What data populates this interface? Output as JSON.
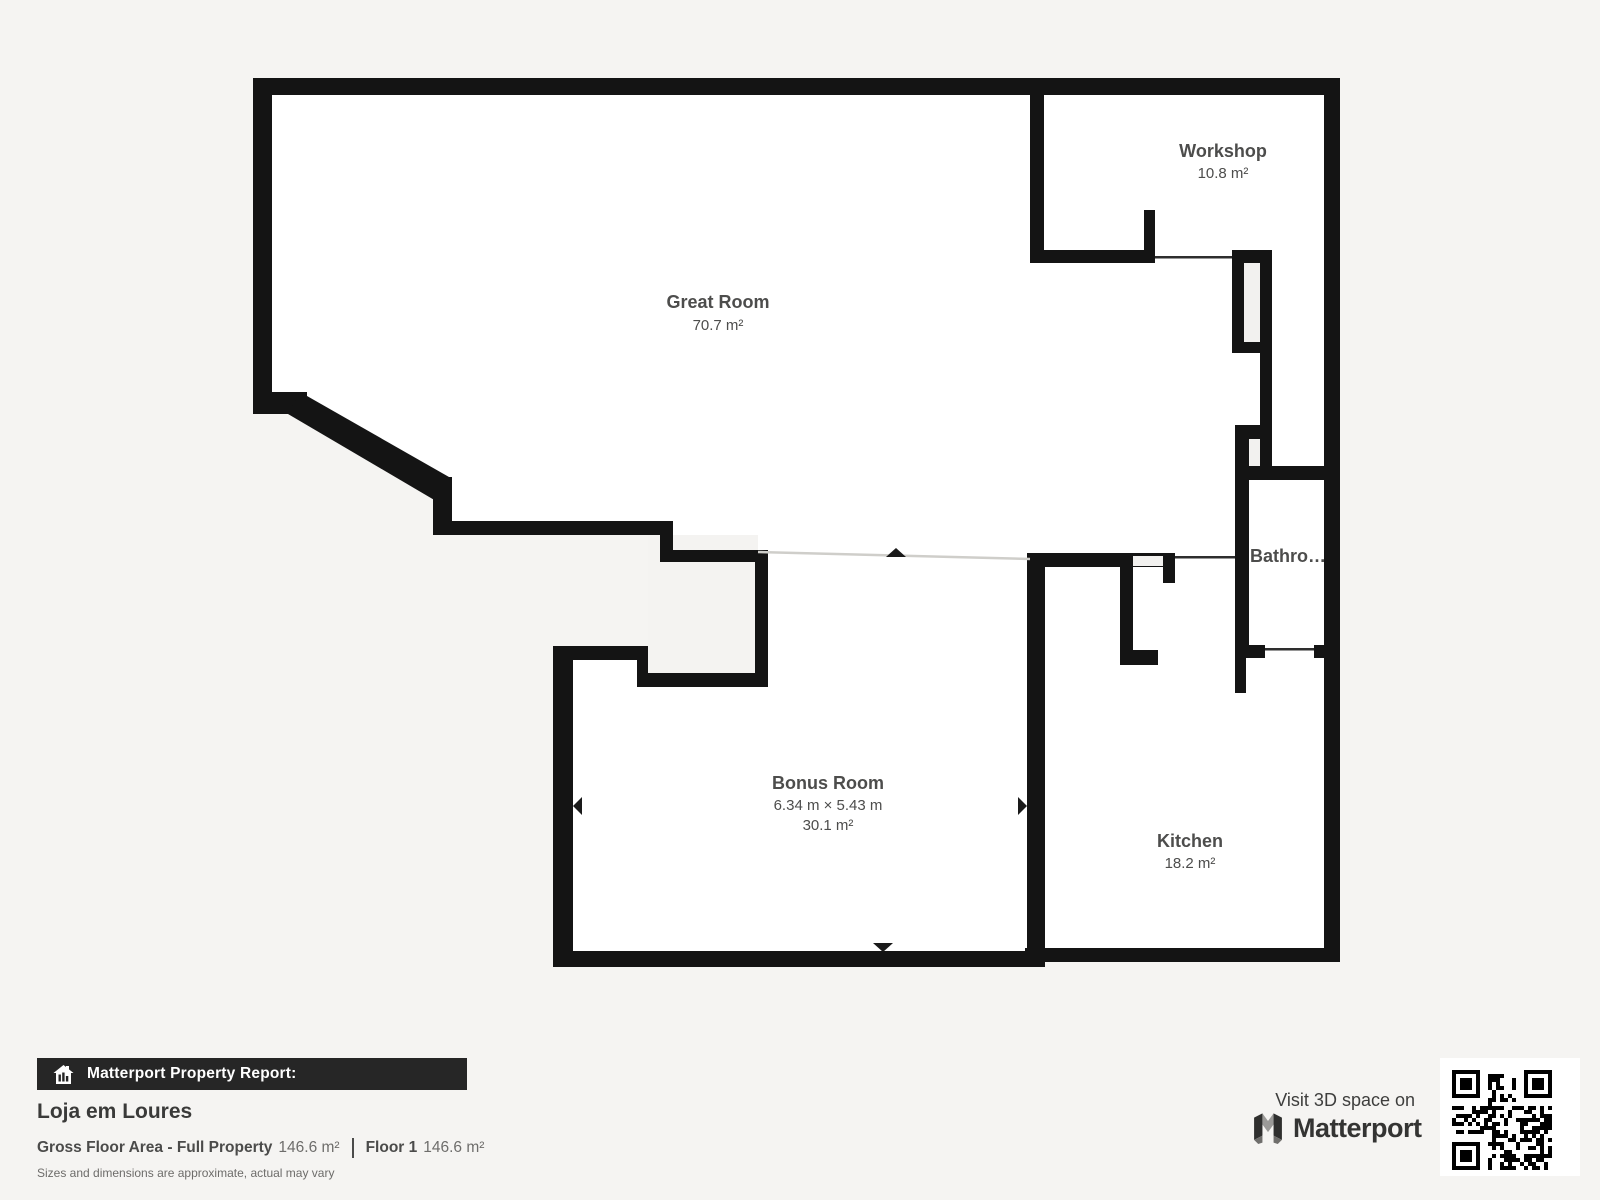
{
  "plan": {
    "rooms": [
      {
        "name": "Great Room",
        "area": "70.7 m²"
      },
      {
        "name": "Workshop",
        "area": "10.8 m²"
      },
      {
        "name": "Bathro…"
      },
      {
        "name": "Bonus Room",
        "dimensions": "6.34 m × 5.43 m",
        "area": "30.1 m²"
      },
      {
        "name": "Kitchen",
        "area": "18.2 m²"
      }
    ]
  },
  "footer": {
    "report_label": "Matterport Property Report:",
    "property_name": "Loja em Loures",
    "gross_floor_area_label": "Gross Floor Area - Full Property",
    "gross_floor_area_value": "146.6 m²",
    "floor_label": "Floor 1",
    "floor_value": "146.6 m²",
    "disclaimer": "Sizes and dimensions are approximate, actual may vary"
  },
  "cta": {
    "visit_label": "Visit 3D space on",
    "brand": "Matterport"
  },
  "colors": {
    "background": "#f5f4f2",
    "wall": "#141414",
    "floor": "#ffffff",
    "report_bar": "#262626",
    "label_text": "#4d4d4c"
  }
}
